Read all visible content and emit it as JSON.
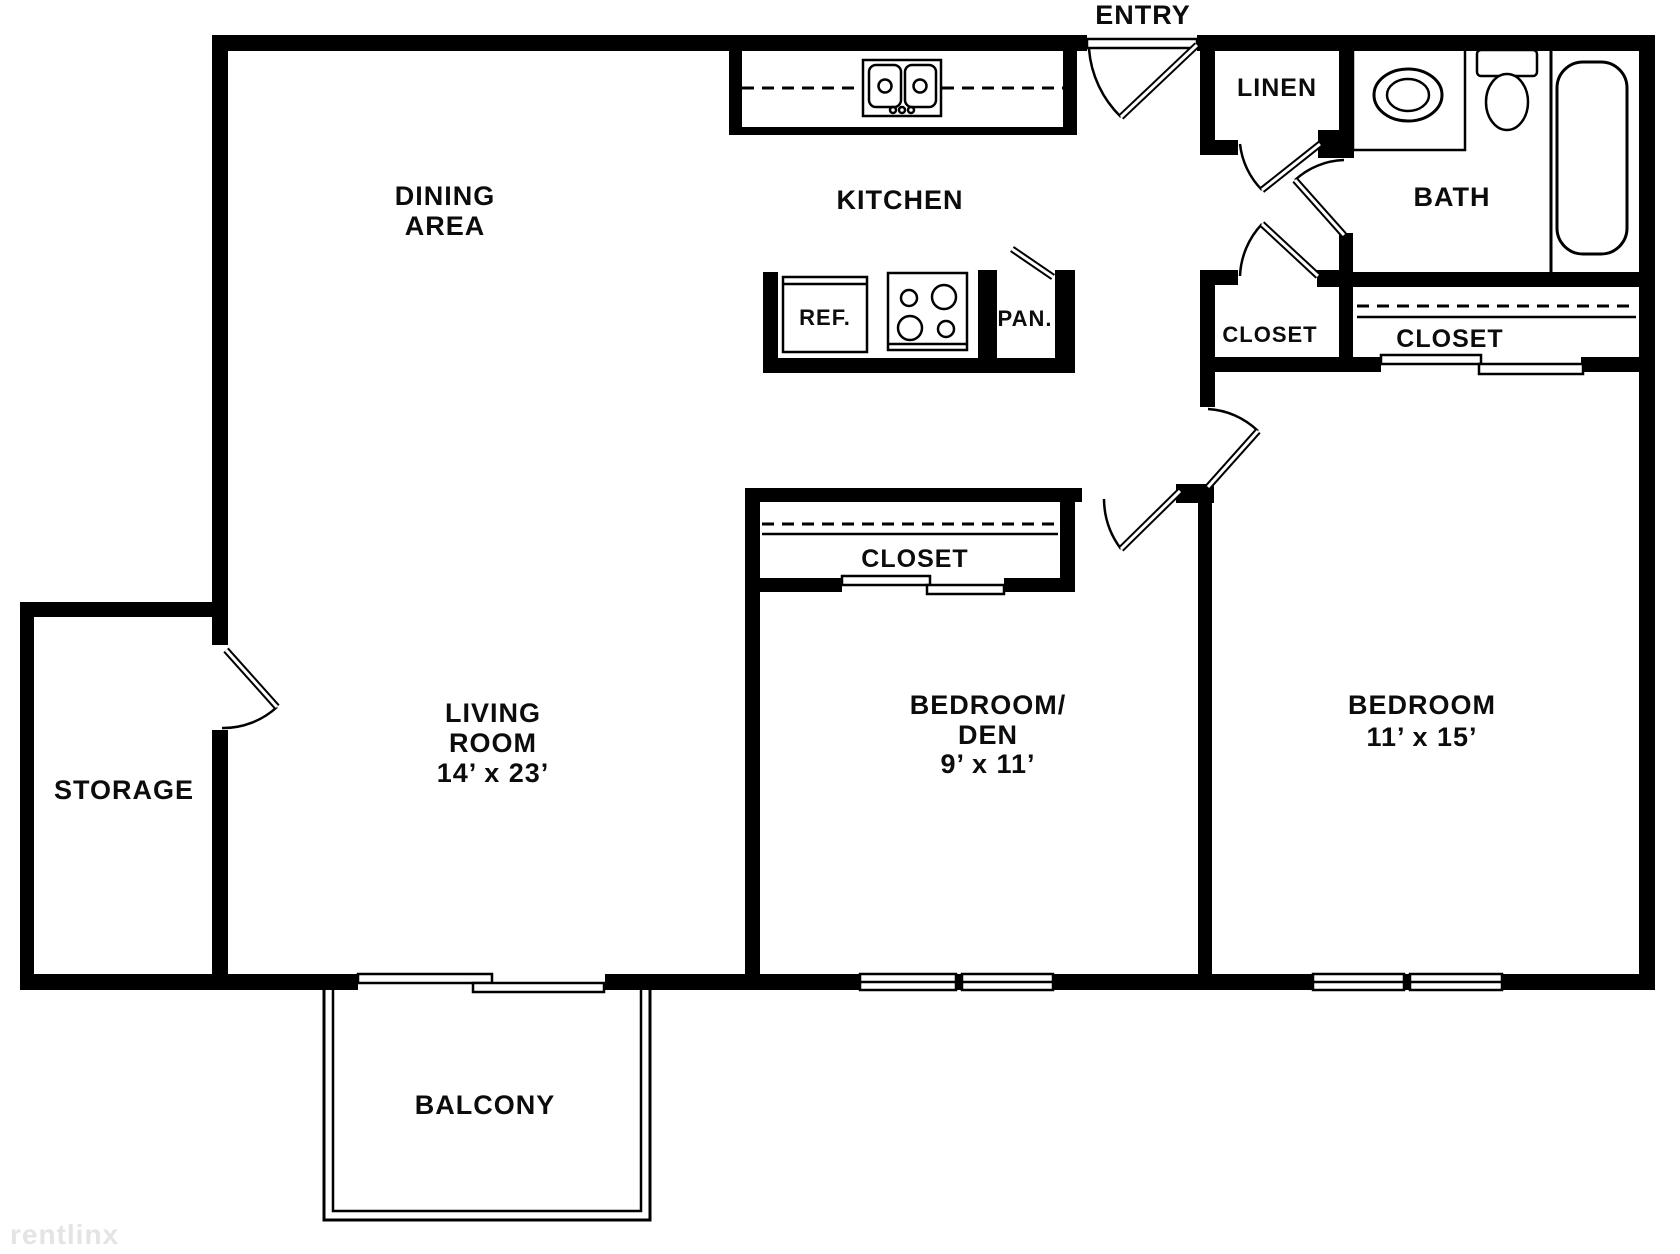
{
  "meta": {
    "watermark": "rentlinx"
  },
  "colors": {
    "wall": "#000000",
    "background": "#ffffff",
    "watermark_text": "#e4e4e4"
  },
  "rooms": {
    "entry": {
      "label": "ENTRY"
    },
    "dining": {
      "line1": "DINING",
      "line2": "AREA"
    },
    "kitchen": {
      "label": "KITCHEN"
    },
    "linen": {
      "label": "LINEN"
    },
    "bath": {
      "label": "BATH"
    },
    "hall_closet": {
      "label": "CLOSET"
    },
    "bedroom_closet": {
      "label": "CLOSET"
    },
    "den_closet": {
      "label": "CLOSET"
    },
    "bedroom_den": {
      "line1": "BEDROOM/",
      "line2": "DEN",
      "dims": "9’ x 11’"
    },
    "bedroom": {
      "line1": "BEDROOM",
      "dims": "11’ x 15’"
    },
    "living": {
      "line1": "LIVING",
      "line2": "ROOM",
      "dims": "14’ x 23’"
    },
    "storage": {
      "label": "STORAGE"
    },
    "balcony": {
      "label": "BALCONY"
    }
  },
  "fixtures": {
    "refrigerator": {
      "label": "REF."
    },
    "pantry": {
      "label": "PAN."
    }
  }
}
